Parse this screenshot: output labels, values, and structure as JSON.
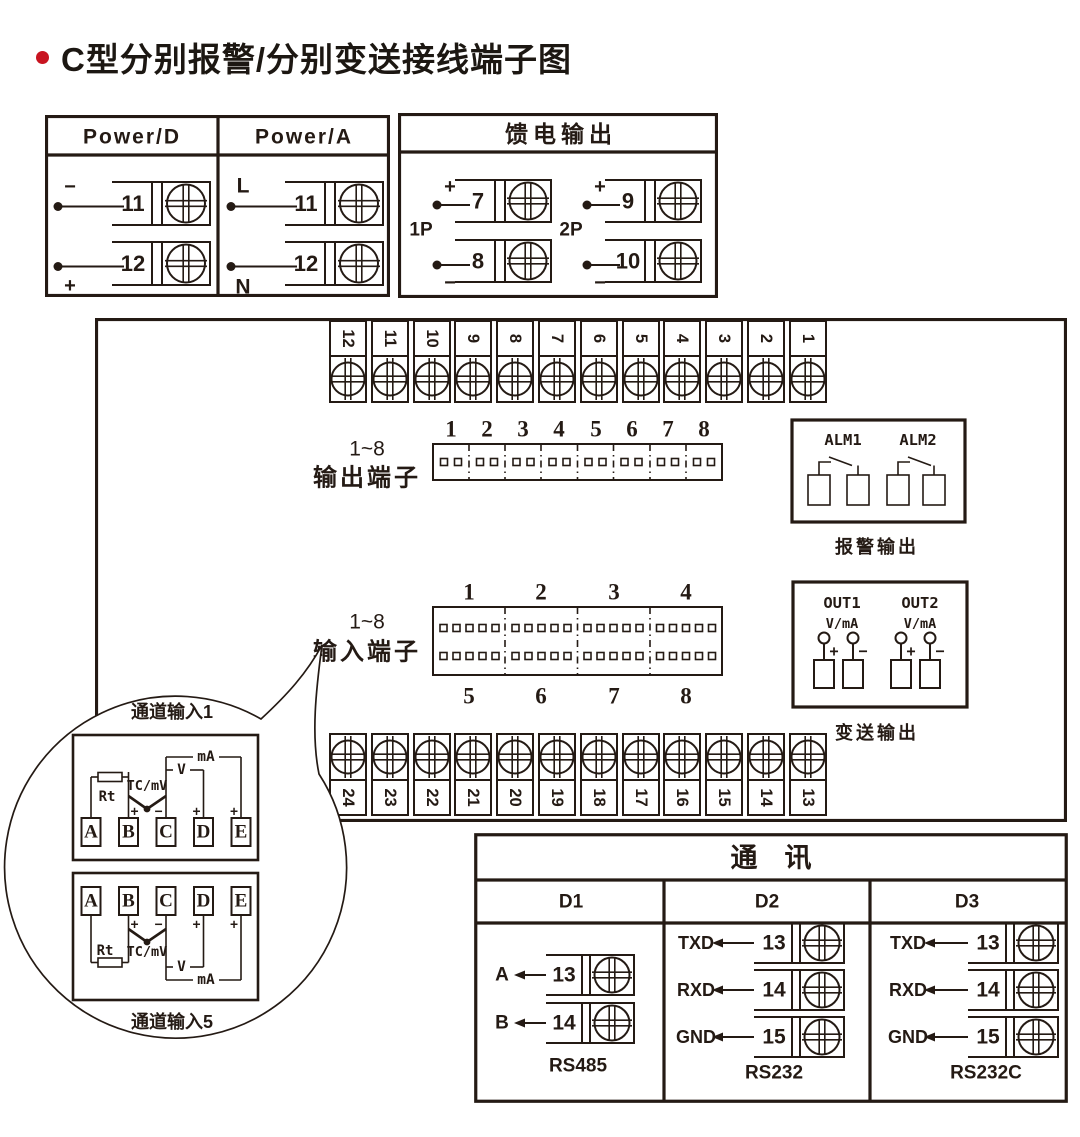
{
  "title": {
    "text": "C型分别报警/分别变送接线端子图"
  },
  "colors": {
    "line": "#241a14",
    "accent": "#c81420",
    "background": "#ffffff"
  },
  "power": {
    "sections": [
      {
        "header": "Power/D",
        "terminals": [
          {
            "sign": "−",
            "num": "11"
          },
          {
            "sign": "+",
            "num": "12"
          }
        ]
      },
      {
        "header": "Power/A",
        "terminals": [
          {
            "sign": "L",
            "num": "11"
          },
          {
            "sign": "N",
            "num": "12"
          }
        ]
      }
    ]
  },
  "feed": {
    "header": "馈电输出",
    "groups": [
      {
        "label": "1P",
        "terminals": [
          {
            "sign": "+",
            "num": "7"
          },
          {
            "sign": "−",
            "num": "8"
          }
        ]
      },
      {
        "label": "2P",
        "terminals": [
          {
            "sign": "+",
            "num": "9"
          },
          {
            "sign": "−",
            "num": "10"
          }
        ]
      }
    ]
  },
  "main": {
    "top_strip": [
      "12",
      "11",
      "10",
      "9",
      "8",
      "7",
      "6",
      "5",
      "4",
      "3",
      "2",
      "1"
    ],
    "bottom_strip": [
      "24",
      "23",
      "22",
      "21",
      "20",
      "19",
      "18",
      "17",
      "16",
      "15",
      "14",
      "13"
    ],
    "output": {
      "label1": "1~8",
      "label2": "输出端子",
      "numbers": [
        "1",
        "2",
        "3",
        "4",
        "5",
        "6",
        "7",
        "8"
      ]
    },
    "input": {
      "label1": "1~8",
      "label2": "输入端子",
      "top_numbers": [
        "1",
        "2",
        "3",
        "4"
      ],
      "bottom_numbers": [
        "5",
        "6",
        "7",
        "8"
      ]
    },
    "alarm": {
      "alm1": "ALM1",
      "alm2": "ALM2",
      "caption": "报警输出"
    },
    "out": {
      "out1": "OUT1",
      "out2": "OUT2",
      "vma": "V/mA",
      "plus": "+",
      "minus": "−",
      "caption": "变送输出"
    }
  },
  "callout": {
    "ch1": {
      "title": "通道输入1",
      "terminals": [
        "A",
        "B",
        "C",
        "D",
        "E"
      ],
      "rt": "Rt",
      "tc": "TC/mV",
      "v": "V",
      "ma": "mA",
      "plus": "+",
      "minus": "−"
    },
    "ch5": {
      "title": "通道输入5",
      "terminals": [
        "A",
        "B",
        "C",
        "D",
        "E"
      ],
      "rt": "Rt",
      "tc": "TC/mV",
      "v": "V",
      "ma": "mA",
      "plus": "+",
      "minus": "−"
    }
  },
  "comm": {
    "header": "通　讯",
    "cols": [
      {
        "name": "D1",
        "caption": "RS485",
        "rows": [
          {
            "label": "A",
            "num": "13"
          },
          {
            "label": "B",
            "num": "14"
          }
        ]
      },
      {
        "name": "D2",
        "caption": "RS232",
        "rows": [
          {
            "label": "TXD",
            "num": "13"
          },
          {
            "label": "RXD",
            "num": "14"
          },
          {
            "label": "GND",
            "num": "15"
          }
        ]
      },
      {
        "name": "D3",
        "caption": "RS232C",
        "rows": [
          {
            "label": "TXD",
            "num": "13"
          },
          {
            "label": "RXD",
            "num": "14"
          },
          {
            "label": "GND",
            "num": "15"
          }
        ]
      }
    ]
  }
}
